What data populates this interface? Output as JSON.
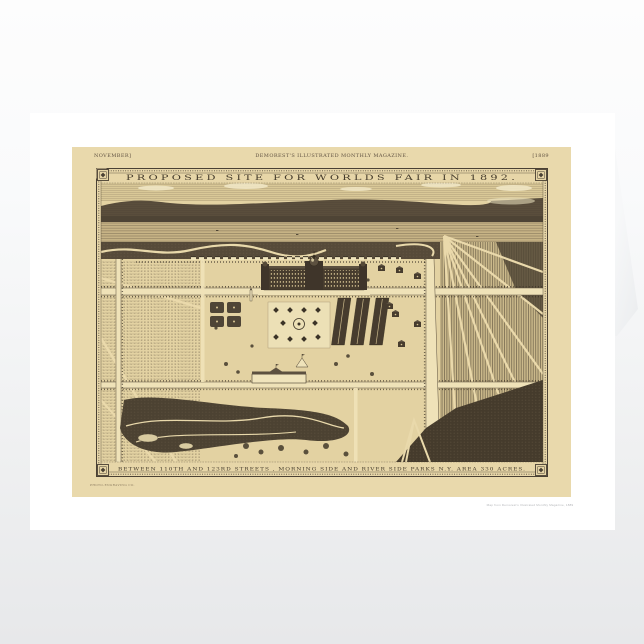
{
  "page": {
    "background_top": "#fdfdfd",
    "background_bottom": "#e7e8ea"
  },
  "card": {
    "paper_color": "#ffffff",
    "print_background": "#e9d9ac",
    "ink_color": "#4a4134",
    "header": {
      "left": "NOVEMBER]",
      "center": "DEMOREST'S ILLUSTRATED MONTHLY MAGAZINE.",
      "right": "[1889"
    },
    "map": {
      "title": "PROPOSED SITE FOR WORLDS FAIR IN 1892.",
      "caption": "BETWEEN 110TH AND 123RD STREETS , MORNING SIDE AND RIVER SIDE PARKS N.Y.  AREA 330 ACRES.",
      "engraver_credit": "PHOTO-ENGRAVING CO."
    },
    "fine_print": "Map from Demorest's Illustrated Monthly Magazine, 1889"
  }
}
